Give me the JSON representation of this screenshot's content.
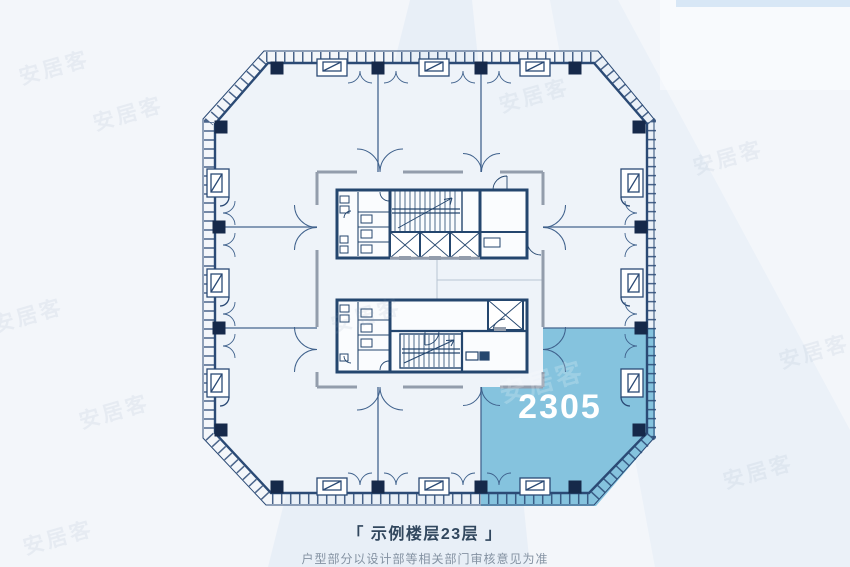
{
  "plan": {
    "highlighted_unit": {
      "number": "2305",
      "fill": "#85c3de",
      "label_color": "#ffffff"
    },
    "watermark": {
      "text": "安居客"
    },
    "colors": {
      "background": "#f3f6fa",
      "building_interior": "#eef3f9",
      "wall": "#2b4a75",
      "column": "#16294a",
      "core_wall": "#939dac",
      "partition": "#44648f",
      "beam_tint": "#dbe7f5"
    }
  },
  "caption": {
    "title": "「 示例楼层23层 」",
    "subtitle": "户型部分以设计部等相关部门审核意见为准"
  }
}
